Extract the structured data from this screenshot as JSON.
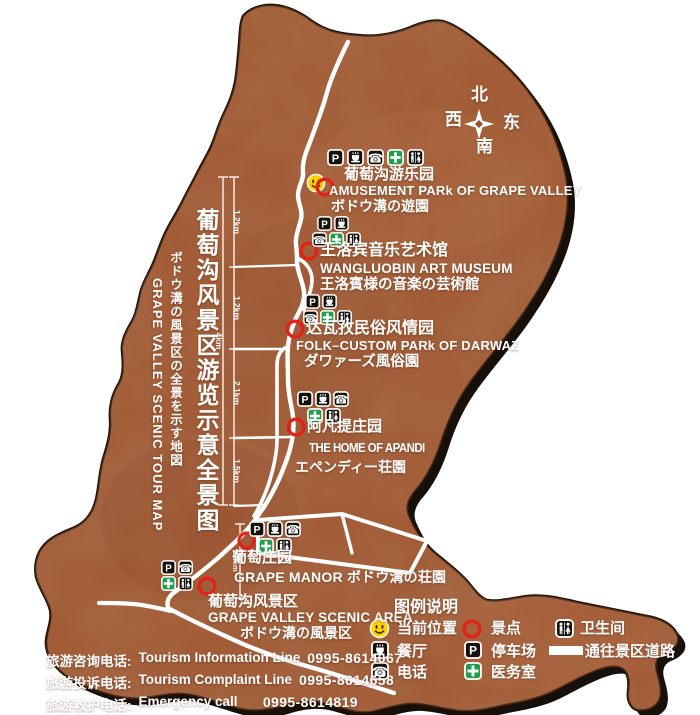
{
  "titles": {
    "cn": "葡萄沟风景区游览示意全景图",
    "jp": "ボドウ溝の風景区の全景を示す地図",
    "en": "GRAPE  VALLEY  SCENIC  TOUR  MAP"
  },
  "compass": {
    "n": "北",
    "s": "南",
    "e": "东",
    "w": "西"
  },
  "attractions": [
    {
      "id": "amusement-park",
      "services": [
        "parking",
        "restaurant",
        "phone",
        "medical",
        "toilet"
      ],
      "cn": "葡萄沟游乐园",
      "en": "AMUSEMENT PARk OF GRAPE VALLEY",
      "jp": "ボドウ溝の遊園"
    },
    {
      "id": "wangluobin-art-museum",
      "services": [
        "parking",
        "restaurant",
        "phone",
        "medical",
        "toilet"
      ],
      "cn": "王洛宾音乐艺术馆",
      "en": "WANGLUOBIN ART MUSEUM",
      "jp": "王洛賓様の音楽の芸術館"
    },
    {
      "id": "darwaz-folk-custom-park",
      "services": [
        "parking",
        "restaurant",
        "phone",
        "medical",
        "toilet"
      ],
      "cn": "达瓦孜民俗风情园",
      "en": "FOLK–CUSTOM PARk OF DARWAZ",
      "jp": "ダワァーズ風俗園"
    },
    {
      "id": "home-of-apandi",
      "services": [
        "parking",
        "restaurant",
        "phone",
        "medical",
        "toilet"
      ],
      "cn": "阿凡提庄园",
      "en": "THE HOME OF APANDI",
      "jp": "エペンディー荘園"
    },
    {
      "id": "grape-manor",
      "services": [
        "parking",
        "restaurant",
        "phone",
        "medical",
        "toilet"
      ],
      "cn": "葡萄庄园",
      "en_jp": "GRAPE MANOR ボドウ溝の荘園"
    },
    {
      "id": "grape-valley-scenic-area",
      "services": [
        "parking",
        "phone",
        "medical",
        "toilet"
      ],
      "cn": "葡萄沟风景区",
      "en": "GRAPE VALLEY SCENIC AREA",
      "jp": "ボドウ溝の風景区"
    }
  ],
  "scale": {
    "seg1": "1.2km",
    "seg2": "1.2km",
    "seg3": "2.1km",
    "seg4": "1.5km",
    "total": "4km",
    "manor": "1.3km"
  },
  "legend": {
    "title": "图例说明",
    "current_location": "当前位置",
    "scenic_spot": "景点",
    "toilet": "卫生间",
    "restaurant": "餐厅",
    "parking": "停车场",
    "road": "通往景区道路",
    "phone": "电话",
    "clinic": "医务室"
  },
  "contacts": [
    {
      "cn": "旅游咨询电话:",
      "en": "Tourism Information Line",
      "num": "0995-8614067"
    },
    {
      "cn": "旅游投诉电话:",
      "en": "Tourism Complaint  Line",
      "num": "0995-8614658"
    },
    {
      "cn": "旅游救护电话:",
      "en": "Emergency  call",
      "num": "0995-8614819"
    }
  ],
  "icons": {
    "parking": "white P in black box",
    "restaurant": "coffee cup in black box",
    "phone": "telephone in black box",
    "medical": "white cross on green box",
    "toilet": "man and woman figures in black box",
    "current_location": "yellow smiley face",
    "scenic_spot": "red ring",
    "road_swatch": "white bar"
  },
  "colors": {
    "map_fill": "#a0552f",
    "map_shadow": "#17100a",
    "road": "#ffffff",
    "marker_red": "#e32119",
    "medical_green": "#1e9e4a",
    "smiley_yellow": "#ffd200",
    "text": "#ffffff"
  }
}
